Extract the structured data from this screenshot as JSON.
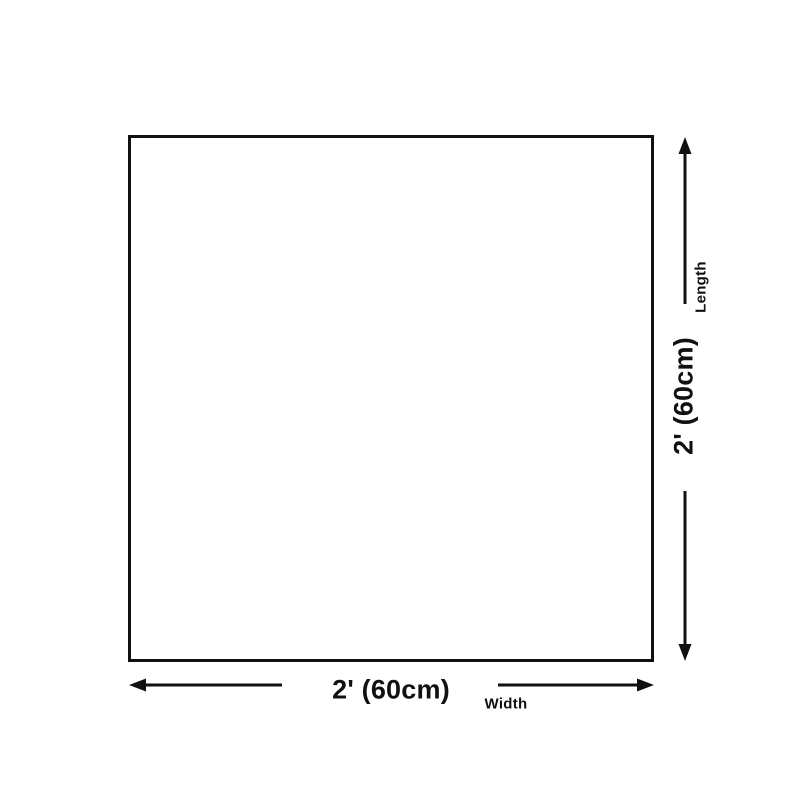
{
  "diagram": {
    "length_axis": {
      "name": "Length",
      "value": "2' (60cm)"
    },
    "width_axis": {
      "name": "Width",
      "value": "2' (60cm)"
    },
    "icons": {
      "vertical": [
        "up-arrow-icon",
        "down-arrow-icon"
      ],
      "horizontal": [
        "left-arrow-icon",
        "right-arrow-icon"
      ]
    },
    "colors": {
      "line": "#111111",
      "background": "#ffffff"
    }
  }
}
